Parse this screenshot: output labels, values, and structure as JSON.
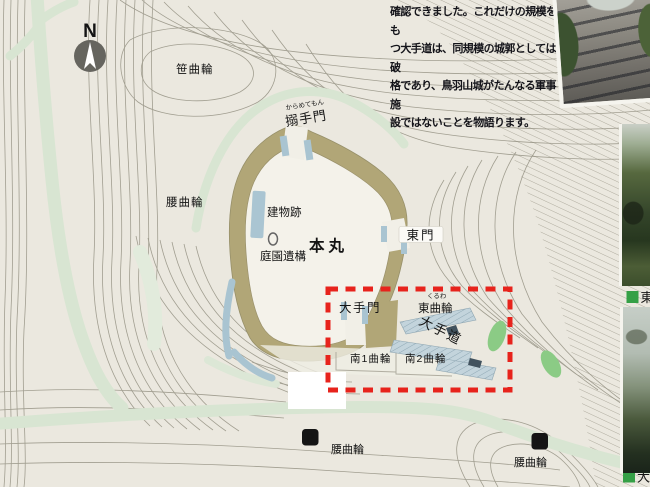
{
  "caption": {
    "lines": [
      "確認できました。これだけの規模をも",
      "つ大手道は、同規模の城郭としては破",
      "格であり、鳥羽山城がたんなる軍事施",
      "設ではないことを物語ります。"
    ]
  },
  "compass": {
    "label": "N"
  },
  "map_labels": {
    "sasa_kuruwa": "笹曲輪",
    "koshi_kuruwa": "腰曲輪",
    "karamete_mon": "搦手門",
    "karamete_mon_furigana": "からめてもん",
    "tatemono_ato": "建物跡",
    "honmaru": "本丸",
    "teien_iko": "庭園遺構",
    "higashi_mon": "東門",
    "ote_mon": "大手門",
    "higashi_kuruwa": "東曲輪",
    "higashi_kuruwa_furigana": "くるわ",
    "ote_michi": "大手道",
    "minami_1_kuruwa": "南1曲輪",
    "minami_2_kuruwa": "南2曲輪",
    "parking": "P",
    "legend_east": "東",
    "legend_ote": "大"
  },
  "colors": {
    "background": "#ebe8df",
    "plateau": "#f4f2ea",
    "earthwork": "#b1a677",
    "path_green": "#d8e5d2",
    "feature_blue": "#a9c4d1",
    "highlight_red": "#e7231c",
    "legend_green": "#35a046",
    "contour": "#8f8c7d"
  }
}
